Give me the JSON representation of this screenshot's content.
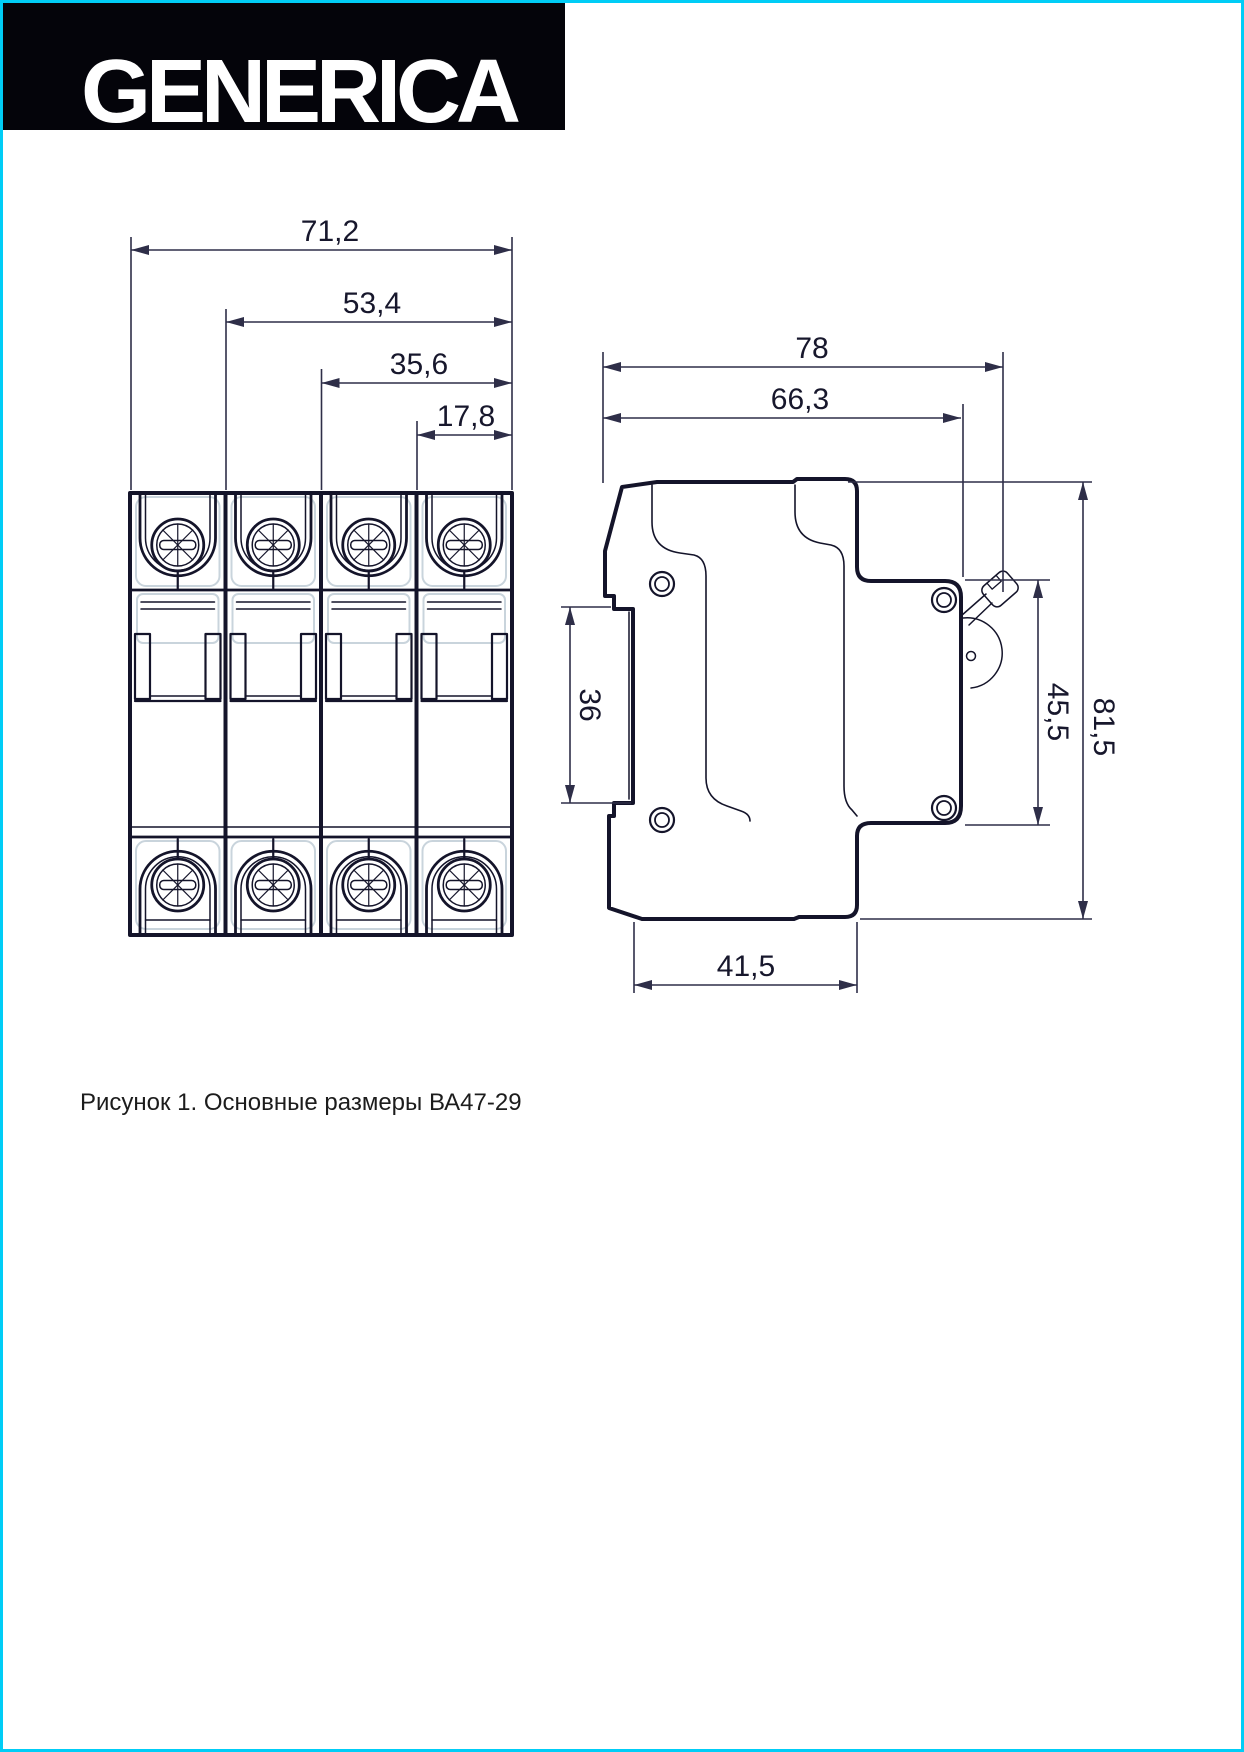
{
  "logo": {
    "text": "GENERICA",
    "bar_color": "#04040a",
    "text_color": "#ffffff"
  },
  "page": {
    "border_color": "#00cdf6",
    "background": "#ffffff"
  },
  "caption": {
    "text": "Рисунок 1. Основные размеры ВА47-29"
  },
  "drawing": {
    "line_color": "#14142a",
    "light_line_color": "#c9d4dc",
    "front_view": {
      "dim_total_width": "71,2",
      "dim_three_pole": "53,4",
      "dim_two_pole": "35,6",
      "dim_one_pole": "17,8"
    },
    "side_view": {
      "dim_total_depth": "78",
      "dim_body_depth": "66,3",
      "dim_din_channel": "36",
      "dim_front_height": "45,5",
      "dim_total_height": "81,5",
      "dim_base_depth": "41,5"
    }
  }
}
